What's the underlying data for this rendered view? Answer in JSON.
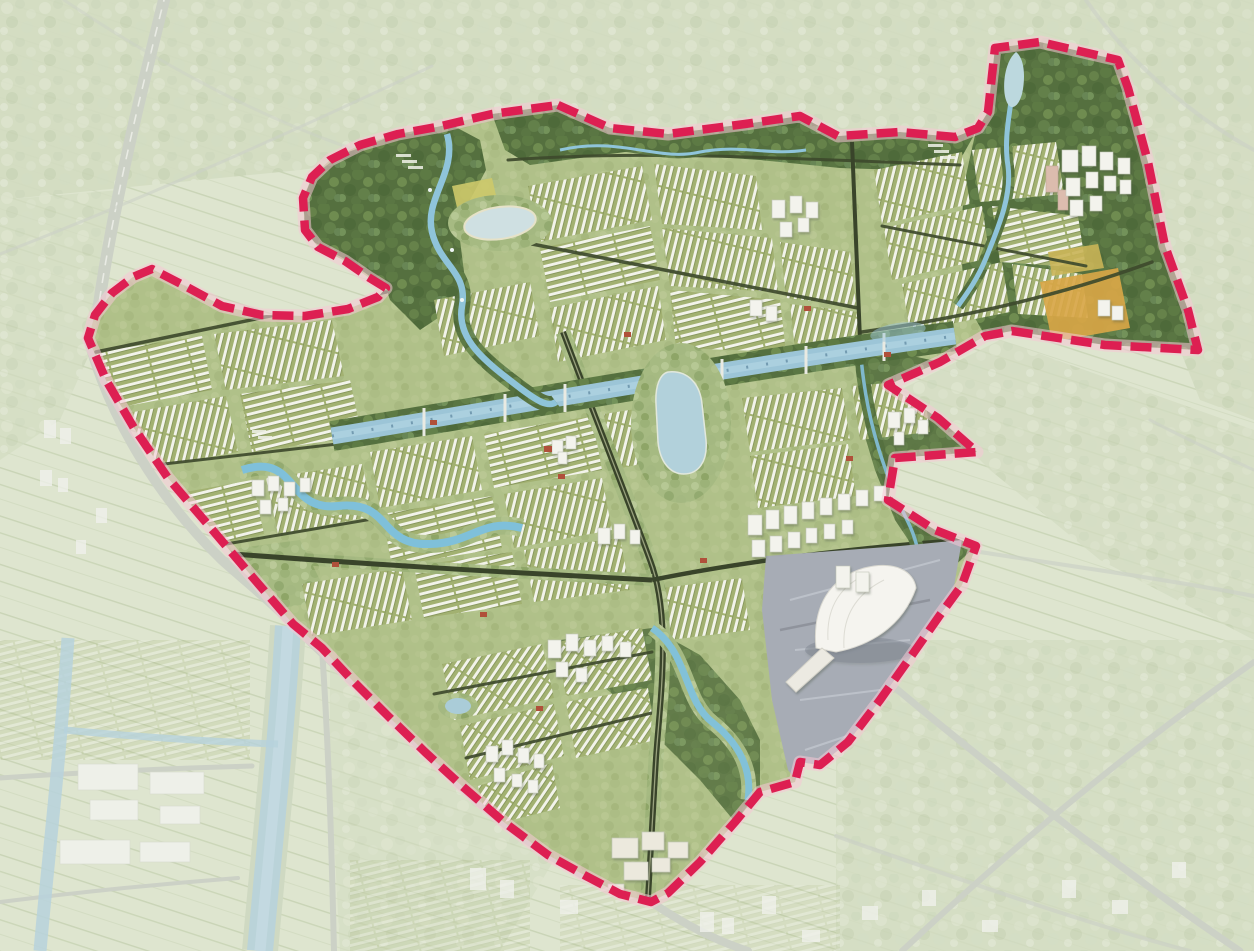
{
  "scene": {
    "title": "Urban masterplan aerial rendering",
    "kind": "3D bird's-eye render of a planned district; highlighted site inside a pink dashed boundary, surrounding land faded",
    "text_labels": []
  },
  "palette": {
    "boundary": "#dd1f52",
    "boundary_halo": "#f6c9d6",
    "faded_land": "#dee5cf",
    "forest": "#55703f",
    "parkland": "#a6ba82",
    "housing_row_white": "#f2f3ea",
    "housing_base": "#a2b171",
    "canal_water": "#9cc5d7",
    "river_water": "#7fc0da",
    "lake_water": "#b2d1db",
    "road_dark": "#3e4a2d",
    "plaza_grey": "#a7acb5",
    "building_white": "#f3f3ed",
    "accent_roof_red": "#b0503a",
    "farm_orange": "#d8a647"
  },
  "boundary": {
    "style": "dashed",
    "color": "#dd1f52",
    "path_d": "M558,105 L610,128 L668,134 L745,124 L800,116 L838,136 L900,132 L955,137 L978,128 L988,112 L995,48 L1040,42 L1118,60 L1128,88 L1148,162 L1165,246 L1188,310 L1198,350 L1105,345 L1012,331 L985,336 L940,362 L888,385 L938,418 L977,452 L895,458 L888,500 L935,530 L976,546 L962,585 L940,615 L912,655 L880,700 L848,742 L820,765 L800,762 L795,782 L760,792 L735,822 L700,862 L668,893 L651,902 L620,894 L586,876 L548,855 L505,823 L462,786 L425,752 L388,716 L352,680 L322,648 L293,624 L255,580 L210,527 L168,478 L134,428 L106,380 L88,338 L95,315 L112,293 L133,277 L152,269 L185,286 L222,306 L262,315 L305,316 L348,309 L378,297 L386,288 L368,277 L345,261 L318,247 L305,230 L303,198 L312,177 L330,160 L360,145 L398,134 L437,127 L492,114 Z"
  },
  "features": [
    {
      "name": "site-boundary",
      "kind": "pink dashed outline"
    },
    {
      "name": "central-canal",
      "kind": "water"
    },
    {
      "name": "central-lake",
      "kind": "water"
    },
    {
      "name": "northwest-lake",
      "kind": "water"
    },
    {
      "name": "meandering-rivers",
      "kind": "water"
    },
    {
      "name": "landmark-hall",
      "kind": "white shell-roof building on plaza"
    },
    {
      "name": "central-plaza",
      "kind": "paved"
    },
    {
      "name": "row-housing-grids",
      "kind": "residential fabric"
    },
    {
      "name": "tower-clusters",
      "kind": "high-rise"
    },
    {
      "name": "forest-belt",
      "kind": "green"
    },
    {
      "name": "farm-fields",
      "kind": "agriculture"
    },
    {
      "name": "perimeter-highway",
      "kind": "road"
    },
    {
      "name": "surrounding-city",
      "kind": "faded context"
    }
  ]
}
